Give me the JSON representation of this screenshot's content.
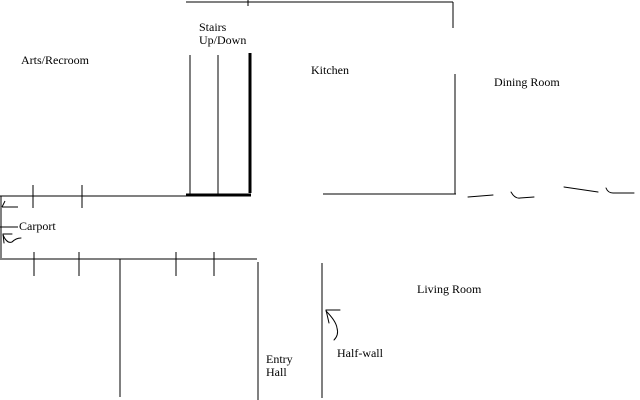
{
  "canvas": {
    "background_color": "#ffffff",
    "line_color": "#000000"
  },
  "rooms": {
    "arts_recroom": {
      "label": "Arts/Recroom"
    },
    "stairs": {
      "label_line1": "Stairs",
      "label_line2": "Up/Down"
    },
    "kitchen": {
      "label": "Kitchen"
    },
    "dining_room": {
      "label": "Dining Room"
    },
    "carport": {
      "label": "Carport"
    },
    "living_room": {
      "label": "Living Room"
    },
    "entry_hall": {
      "label_line1": "Entry",
      "label_line2": "Hall"
    },
    "half_wall": {
      "label": "Half-wall"
    }
  }
}
